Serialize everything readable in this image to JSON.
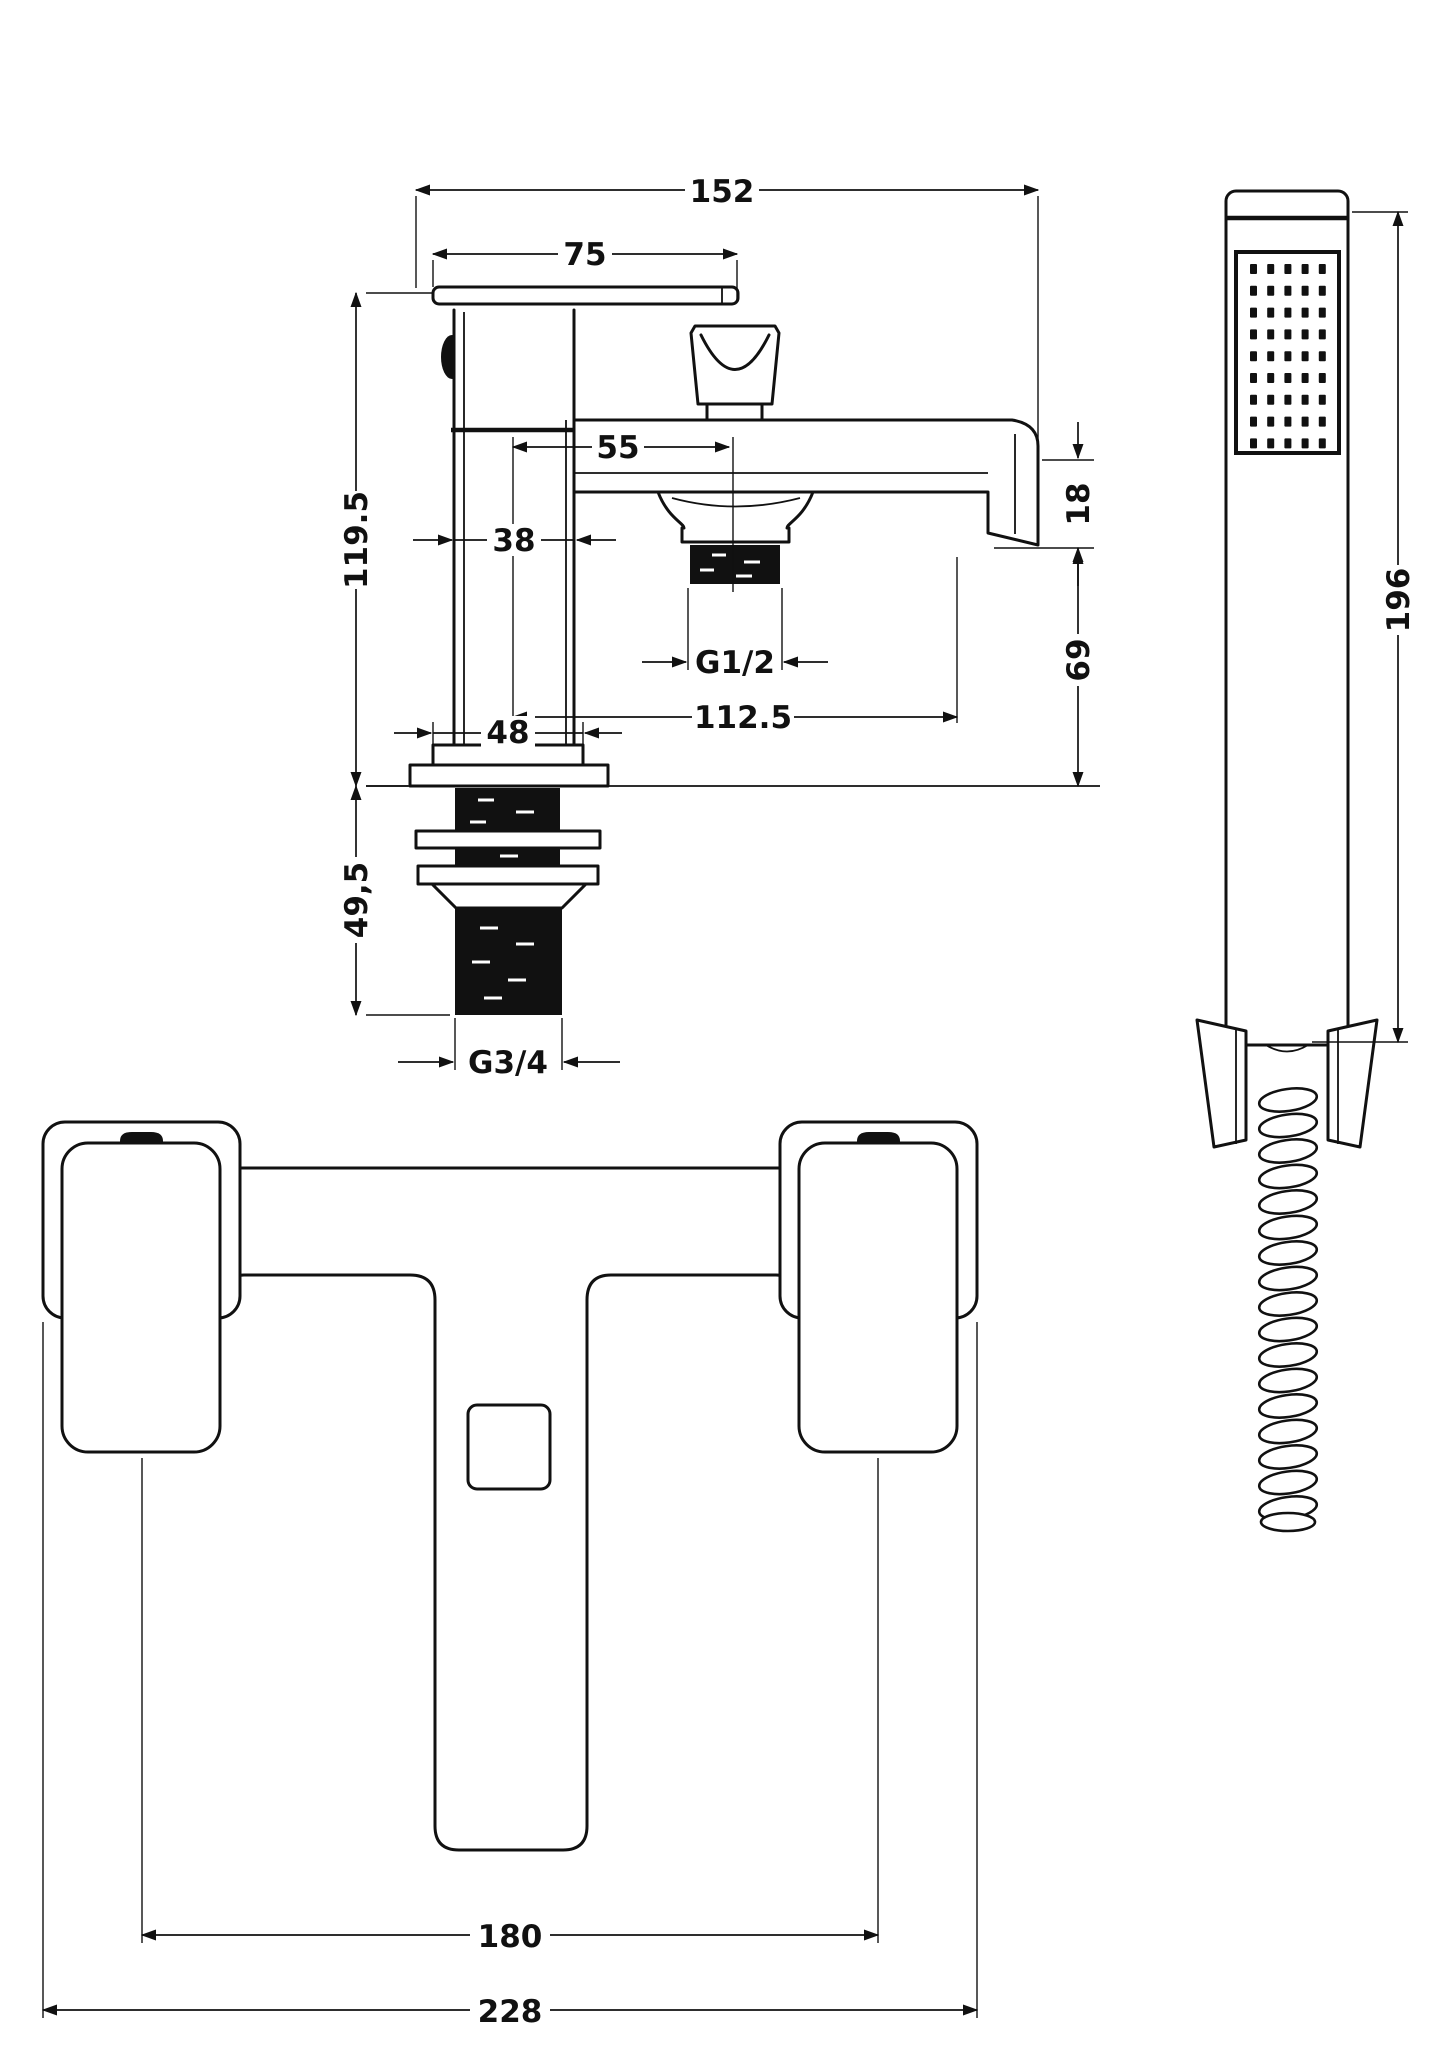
{
  "document": {
    "type": "technical-drawing",
    "product": "bath shower mixer tap",
    "line_color": "#111111",
    "background": "#ffffff"
  },
  "views": {
    "side": {
      "label": "side-elevation",
      "dimensions": {
        "overall_projection": "152",
        "lever_length": "75",
        "body_height": "119.5",
        "outlet_offset": "55",
        "body_width": "38",
        "spout_end_height": "18",
        "spout_clearance": "69",
        "outlet_reach": "112.5",
        "shower_outlet_thread": "G1/2",
        "base_width": "48",
        "shank_length": "49,5",
        "inlet_thread": "G3/4"
      }
    },
    "handset": {
      "label": "shower-handset-elevation",
      "dimensions": {
        "handset_length": "196"
      },
      "spray_grid": {
        "cols": 5,
        "rows": 9
      },
      "hose": {
        "segments": 17
      }
    },
    "front": {
      "label": "front-elevation",
      "dimensions": {
        "inlet_centres": "180",
        "overall_width": "228"
      }
    }
  }
}
